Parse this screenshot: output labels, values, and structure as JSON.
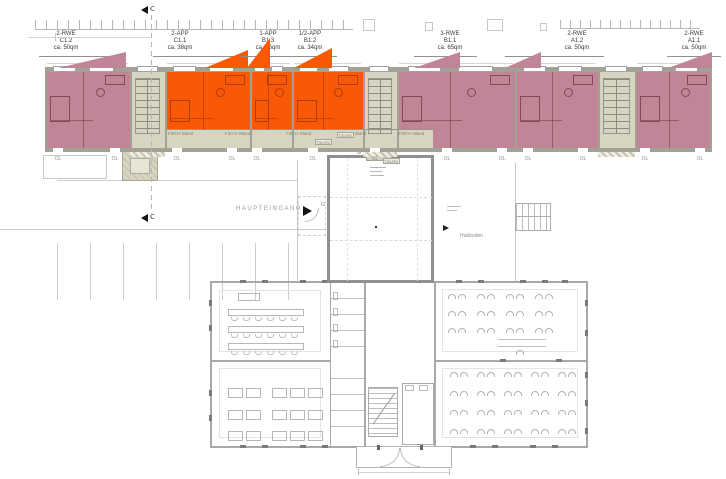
{
  "units": [
    {
      "type": "2-RWE",
      "id": "C1.2",
      "area": "ca. 50qm",
      "category": "pink"
    },
    {
      "type": "2-APP",
      "id": "C1.1",
      "area": "ca. 38qm",
      "category": "orange"
    },
    {
      "type": "1-APP",
      "id": "B1.3",
      "area": "ca. 16qm",
      "category": "orange"
    },
    {
      "type": "1/2-APP",
      "id": "B1.2",
      "area": "ca. 34qm",
      "category": "orange"
    },
    {
      "type": "3-RWE",
      "id": "B1.1",
      "area": "ca. 65qm",
      "category": "pink"
    },
    {
      "type": "2-RWE",
      "id": "A1.2",
      "area": "ca. 50qm",
      "category": "pink"
    },
    {
      "type": "2-RWE",
      "id": "A1.1",
      "area": "ca. 50qm",
      "category": "pink"
    }
  ],
  "labels": {
    "section_marker": "C",
    "main_entrance": "HAUPTEINGANG",
    "skylight": "OL",
    "fire_wall": "F30-H Wand",
    "fire_door": "T30-RS",
    "lift_floor": "Hubboden",
    "entrance_door": "G"
  },
  "colors": {
    "apartment_pink": "#c18598",
    "apartment_orange": "#f95806",
    "core_beige": "#d8d4c2",
    "band_wall": "#a3a096",
    "school_wall": "#a9a9a9",
    "faint_line": "#cfcfcf",
    "text_dark": "#3a3a3a",
    "text_gray": "#8c8c8c"
  }
}
